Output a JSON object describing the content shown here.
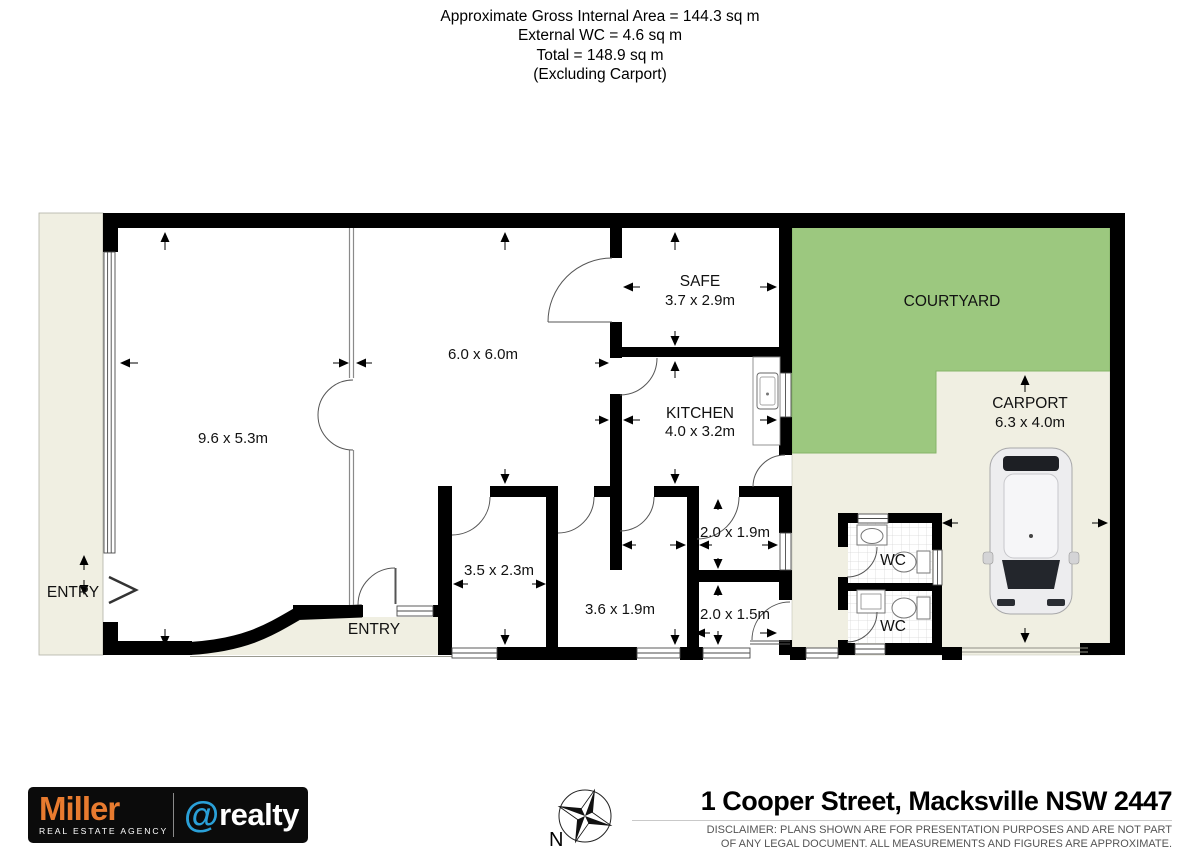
{
  "header": {
    "area_line": "Approximate Gross Internal Area = 144.3 sq m",
    "wc_line": "External WC = 4.6 sq m",
    "total_line": "Total = 148.9 sq m",
    "exclusion_line": "(Excluding Carport)"
  },
  "plan": {
    "rooms": {
      "lounge": {
        "dims": "9.6 x 5.3m"
      },
      "living": {
        "dims": "6.0 x 6.0m"
      },
      "safe": {
        "name": "SAFE",
        "dims": "3.7 x 2.9m"
      },
      "kitchen": {
        "name": "KITCHEN",
        "dims": "4.0 x 3.2m"
      },
      "courtyard": {
        "name": "COURTYARD"
      },
      "carport": {
        "name": "CARPORT",
        "dims": "6.3 x 4.0m"
      },
      "room_3_5": {
        "dims": "3.5 x 2.3m"
      },
      "hall": {
        "dims": "3.6 x 1.9m"
      },
      "store_upper": {
        "dims": "2.0 x 1.9m"
      },
      "store_lower": {
        "dims": "2.0 x 1.5m"
      },
      "wc_upper": {
        "name": "WC"
      },
      "wc_lower": {
        "name": "WC"
      },
      "entry_west": {
        "name": "ENTRY"
      },
      "entry_main": {
        "name": "ENTRY"
      }
    }
  },
  "footer": {
    "logo": {
      "brand": "Miller",
      "tagline": "REAL ESTATE AGENCY",
      "at_symbol": "@",
      "suffix": "realty"
    },
    "compass": {
      "north_label": "N"
    },
    "address": "1 Cooper Street, Macksville NSW 2447",
    "disclaimer_line1": "DISCLAIMER: PLANS SHOWN ARE FOR PRESENTATION PURPOSES AND ARE NOT PART",
    "disclaimer_line2": "OF ANY LEGAL DOCUMENT. ALL MEASUREMENTS AND FIGURES ARE APPROXIMATE."
  },
  "colors": {
    "wall_black": "#000000",
    "courtyard_green": "#9cc87f",
    "outdoor_beige": "#f0efe2",
    "brand_orange": "#e87b2f",
    "brand_blue": "#2aa0d8",
    "disclaimer_gray": "#555555"
  }
}
